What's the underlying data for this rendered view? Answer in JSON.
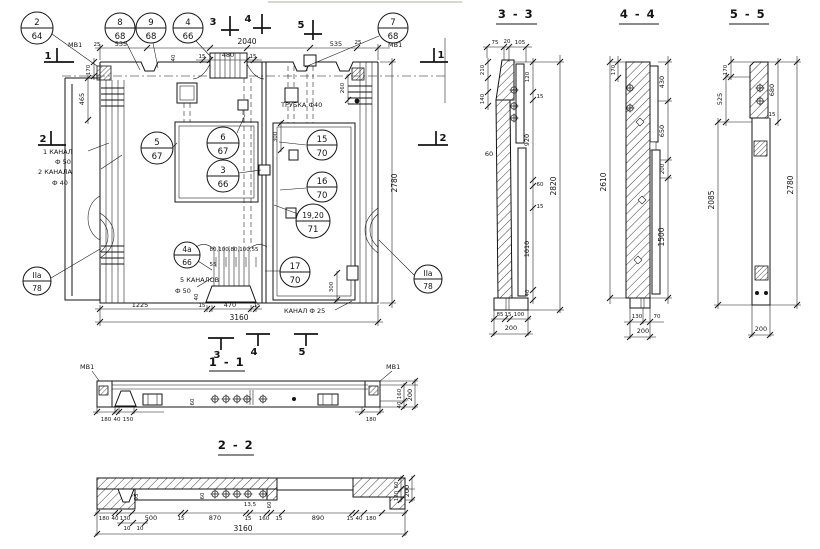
{
  "plan": {
    "balloons": [
      {
        "t": "2",
        "b": "64"
      },
      {
        "t": "8",
        "b": "68"
      },
      {
        "t": "9",
        "b": "68"
      },
      {
        "t": "4",
        "b": "66"
      },
      {
        "t": "7",
        "b": "68"
      },
      {
        "t": "5",
        "b": "67"
      },
      {
        "t": "6",
        "b": "67"
      },
      {
        "t": "3",
        "b": "66"
      },
      {
        "t": "15",
        "b": "70"
      },
      {
        "t": "16",
        "b": "70"
      },
      {
        "t": "19,20",
        "b": "71"
      },
      {
        "t": "4а",
        "b": "66"
      },
      {
        "t": "17",
        "b": "70"
      },
      {
        "t": "IIа",
        "b": "78"
      },
      {
        "t": "IIа",
        "b": "78"
      }
    ],
    "marks": {
      "m1": "1",
      "m2": "2",
      "m3": "3",
      "m4": "4",
      "m5": "5"
    },
    "labels": {
      "mv1_left": "МВ1",
      "d25_l": "25",
      "d535_l": "535",
      "d2040": "2040",
      "d40_top": "40",
      "d15_a": "15",
      "d480": "480",
      "d15_b": "15",
      "d535_r": "535",
      "d25_r": "25",
      "mv1_right": "МВ1",
      "d170": "170",
      "d465": "465",
      "kanal1_line1": "1 КАНАЛ",
      "kanal1_line2": "Ф 50",
      "kanal2_line1": "2 КАНАЛА",
      "kanal2_line2": "Ф 40",
      "trubka": "ТРУБКА Ф40",
      "d260": "260",
      "d300_top": "300",
      "d300_bot": "300",
      "d2780": "2780",
      "d_row": "80,100,80,100,55",
      "d55": "55",
      "kanal5_line1": "5 КАНАЛОВ",
      "kanal5_line2": "Ф 50",
      "d40_bot": "40",
      "d1225": "1225",
      "d15_c": "15",
      "d470": "470",
      "d15_d": "15",
      "kanal25": "КАНАЛ Ф 25",
      "d3160": "3160"
    }
  },
  "sections": {
    "s33": {
      "title": "3 - 3",
      "top": [
        "75",
        "20",
        "105"
      ],
      "left": [
        "210",
        "140",
        "60"
      ],
      "right": [
        "120",
        "15",
        "920",
        "60",
        "15",
        "1010",
        "40"
      ],
      "total": "2820",
      "bottom": [
        "85",
        "15",
        "100"
      ],
      "bottom_total": "200"
    },
    "s44": {
      "title": "4 - 4",
      "left_top": "170",
      "left_total": "2610",
      "right": [
        "430",
        "650",
        "200",
        "1500"
      ],
      "bottom": [
        "130",
        "70"
      ],
      "bottom_total": "200"
    },
    "s55": {
      "title": "5 - 5",
      "left": [
        "170",
        "525",
        "2085"
      ],
      "right": [
        "680",
        "15",
        "2780"
      ],
      "bottom_total": "200"
    },
    "s11": {
      "title": "1 - 1",
      "mv1_left": "МВ1",
      "mv1_right": "МВ1",
      "bottom": [
        "180",
        "40",
        "150",
        "180"
      ],
      "inner": "60",
      "right": [
        "160",
        "40",
        "200"
      ]
    },
    "s22": {
      "title": "2 - 2",
      "bottom": [
        "180",
        "40",
        "130",
        "500",
        "15",
        "870",
        "15",
        "160",
        "15",
        "890",
        "15",
        "40",
        "180"
      ],
      "inner": [
        "95",
        "60",
        "13,5",
        "60"
      ],
      "sub": [
        "10",
        "10"
      ],
      "total": "3160",
      "right": [
        "60",
        "120",
        "200"
      ]
    }
  }
}
